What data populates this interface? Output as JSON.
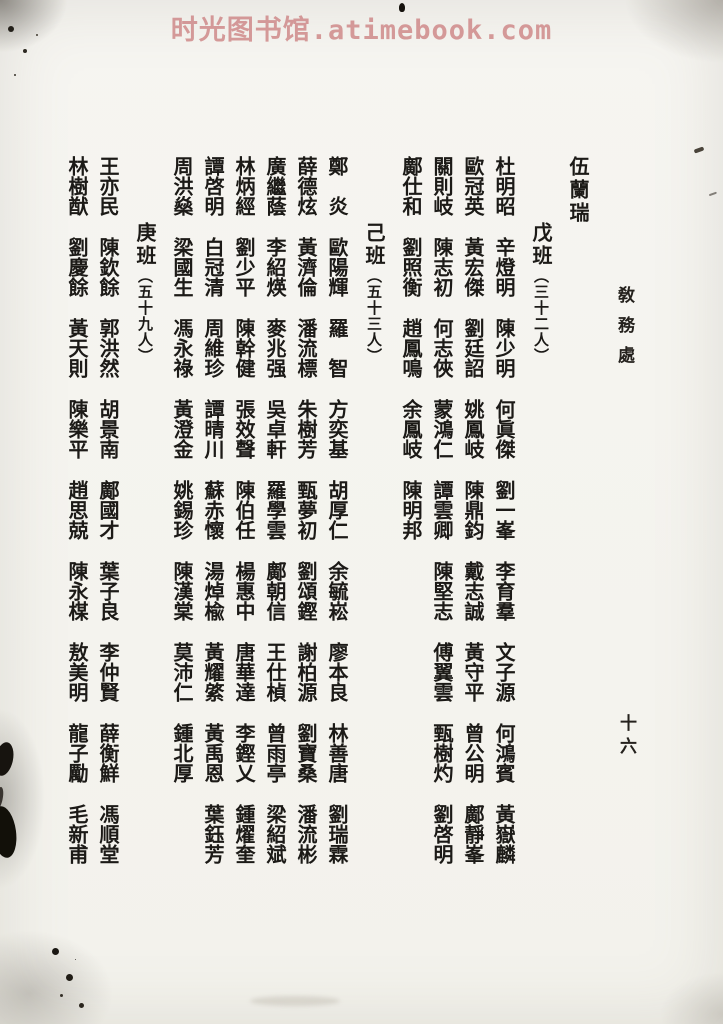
{
  "watermark": {
    "text": "时光图书馆.atimebook.com",
    "color": "#cf8a8a"
  },
  "page": {
    "side_heading": "敎務處",
    "page_number": "十六",
    "ink_color": "#1c1a17",
    "paper_color": "#f5f4f0"
  },
  "carryover": {
    "name": "伍蘭瑞"
  },
  "sections": [
    {
      "title": "戊班",
      "count": "（三十二人）",
      "names": [
        "杜明昭",
        "辛燈明",
        "陳少明",
        "何眞傑",
        "劉一峯",
        "李育羣",
        "文子源",
        "何鴻賓",
        "黃嶽麟",
        "歐冠英",
        "黃宏傑",
        "劉廷詔",
        "姚鳳岐",
        "陳鼎鈞",
        "戴志誠",
        "黃守平",
        "曾公明",
        "鄺靜峯",
        "關則岐",
        "陳志初",
        "何志俠",
        "蒙鴻仁",
        "譚雲卿",
        "陳堅志",
        "傅翼雲",
        "甄樹灼",
        "劉啓明",
        "鄺仕和",
        "劉照衡",
        "趙鳳鳴",
        "余鳳岐",
        "陳明邦"
      ]
    },
    {
      "title": "己班",
      "count": "（五十三人）",
      "names": [
        "鄭炎",
        "歐陽輝",
        "羅智",
        "方奕基",
        "胡厚仁",
        "余毓崧",
        "廖本良",
        "林善唐",
        "劉瑞霖",
        "薛德炫",
        "黃濟倫",
        "潘流標",
        "朱樹芳",
        "甄夢初",
        "劉頌鏗",
        "謝柏源",
        "劉寶桑",
        "潘流彬",
        "廣繼蔭",
        "李紹煐",
        "麥兆强",
        "吳卓軒",
        "羅學雲",
        "鄺朝信",
        "王仕楨",
        "曾雨亭",
        "梁紹斌",
        "林炳經",
        "劉少平",
        "陳幹健",
        "張效聲",
        "陳伯任",
        "楊惠中",
        "唐華達",
        "李鏗乂",
        "鍾燿奎",
        "譚啓明",
        "白冠清",
        "周維珍",
        "譚晴川",
        "蘇赤懷",
        "湯焯楡",
        "黃耀綮",
        "黃禹恩",
        "葉鈺芳",
        "周洪燊",
        "梁國生",
        "馮永祿",
        "黃澄金",
        "姚錫珍",
        "陳漢棠",
        "莫沛仁",
        "鍾北厚"
      ]
    },
    {
      "title": "庚班",
      "count": "（五十九人）",
      "names": [
        "王亦民",
        "陳欽餘",
        "郭洪然",
        "胡景南",
        "鄺國才",
        "葉子良",
        "李仲賢",
        "薛衡鮮",
        "馮順堂",
        "林樹猷",
        "劉慶餘",
        "黃天則",
        "陳樂平",
        "趙思兢",
        "陳永楳",
        "敖美明",
        "龍子勵",
        "毛新甫"
      ]
    }
  ],
  "layout": {
    "names_per_column": 9
  }
}
